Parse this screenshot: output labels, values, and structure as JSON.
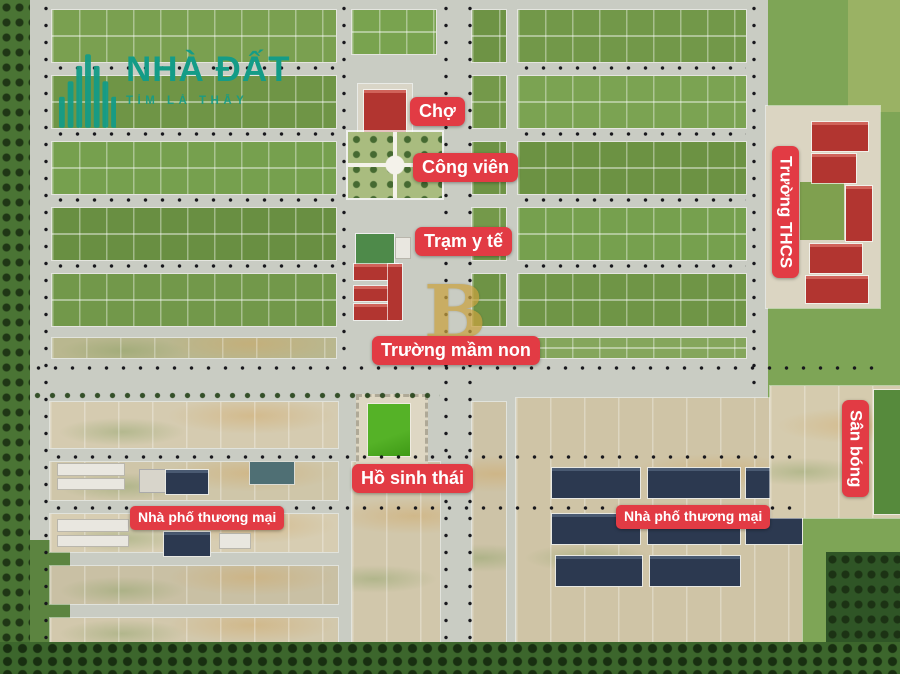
{
  "logo": {
    "title": "NHÀ ĐẤT",
    "subtitle": "TÌM LÀ THẤY"
  },
  "watermark": {
    "letter": "B"
  },
  "labels": {
    "market": "Chợ",
    "park": "Công viên",
    "medical_station": "Trạm y tế",
    "kindergarten": "Trường mầm non",
    "eco_lake": "Hồ sinh thái",
    "shophouse_left": "Nhà phố thương mại",
    "shophouse_right": "Nhà phố thương mại",
    "secondary_school": "Trường THCS",
    "football_field": "Sân bóng"
  },
  "theme": {
    "badge_red": "#e23b44",
    "logo_teal": "#149c87",
    "watermark_gold": "#c9a23f",
    "grass_green": "#6f9546",
    "road_gray": "#c9ccc3",
    "sand": "#d3c9ad",
    "roof_red": "#b23530",
    "roof_navy": "#2c3950",
    "lake_green": "#3f9a16"
  }
}
